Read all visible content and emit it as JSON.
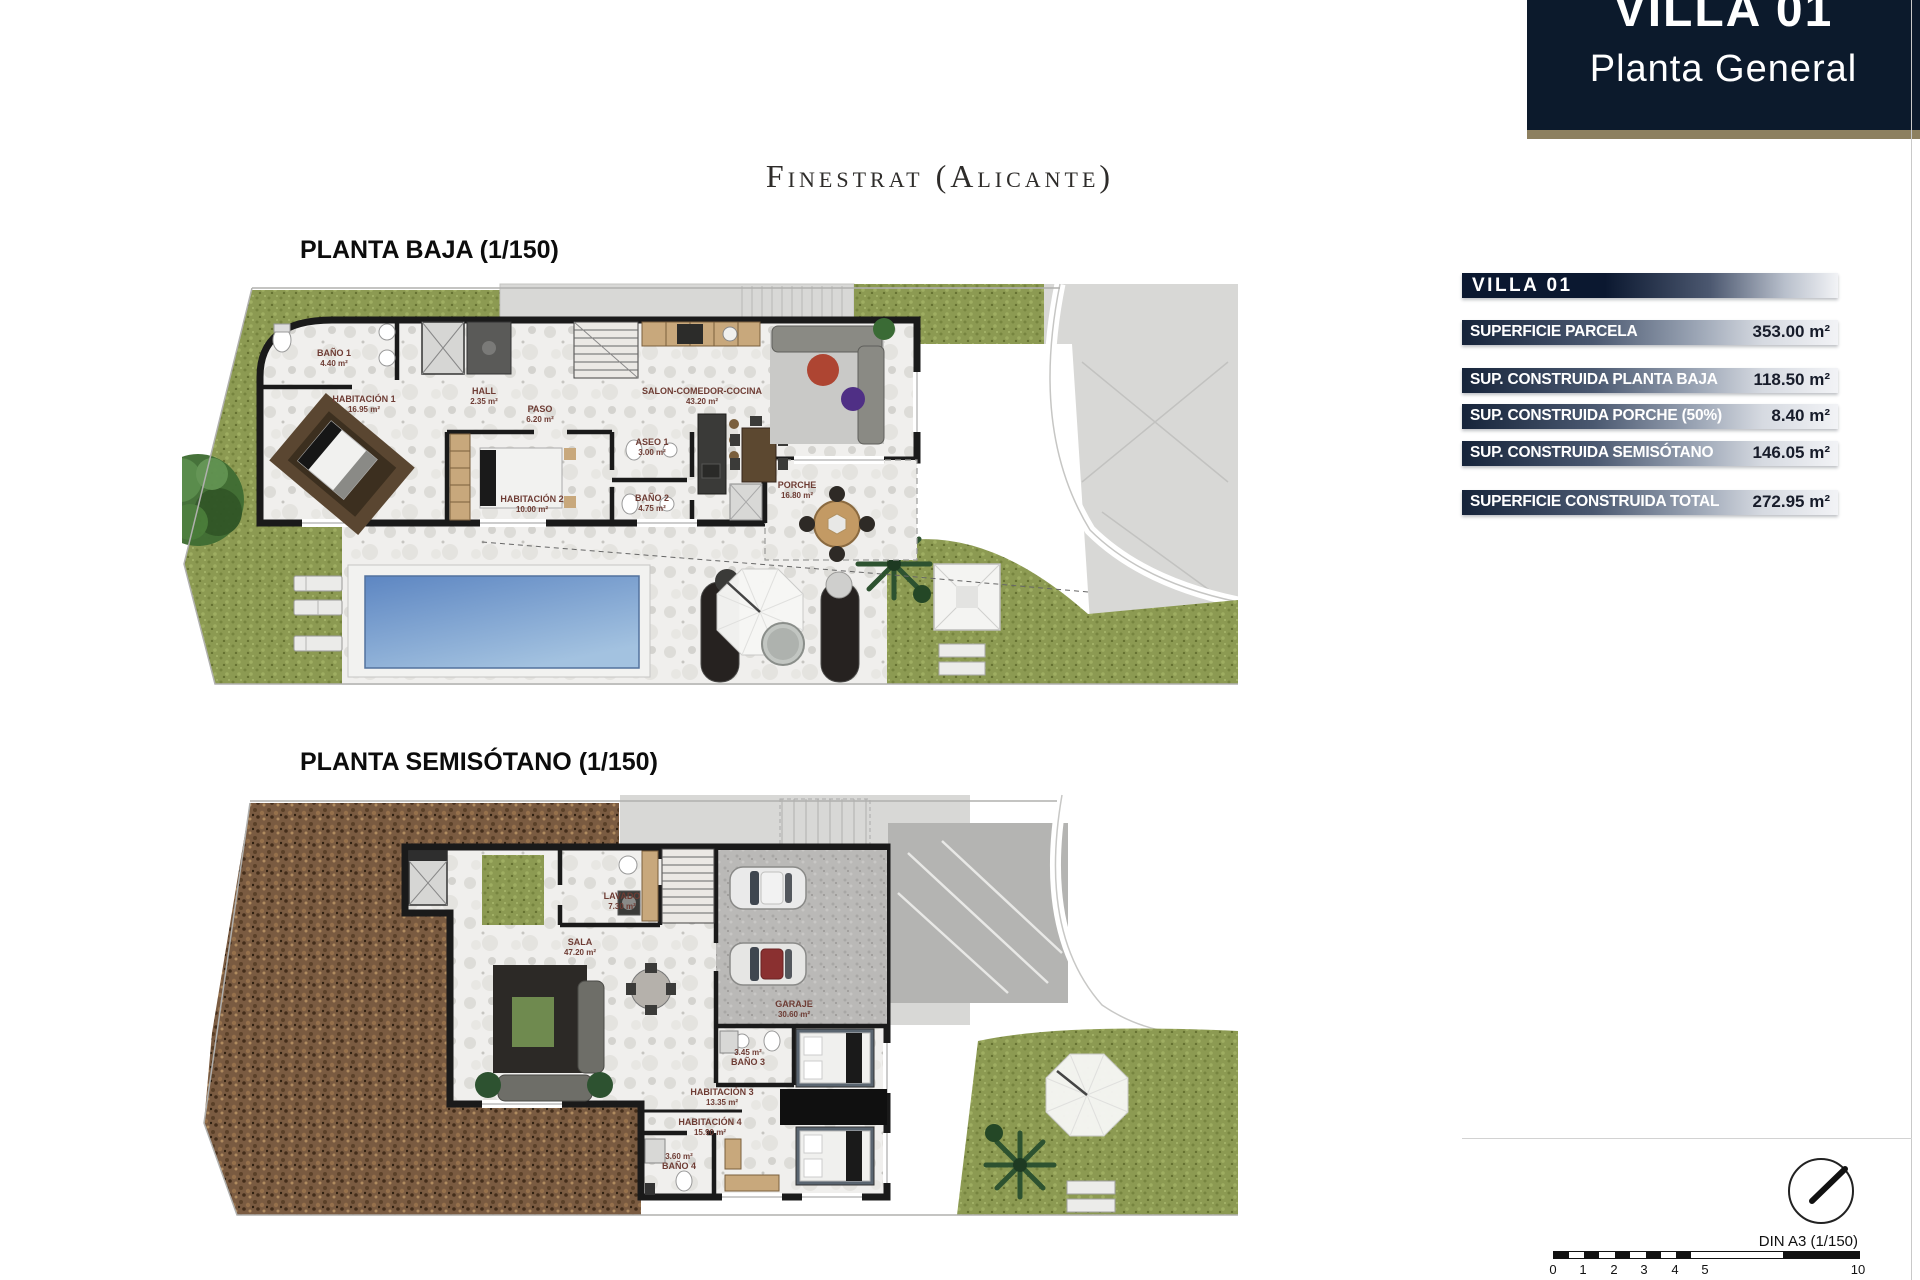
{
  "header": {
    "line1": "VILLA 01",
    "line2": "Planta General"
  },
  "subtitle": "Finestrat (Alicante)",
  "planta_baja": {
    "label": "PLANTA BAJA (1/150)",
    "rooms": [
      {
        "name": "BAÑO 1",
        "area": "4.40 m²"
      },
      {
        "name": "HABITACIÓN 1",
        "area": "16.95 m²"
      },
      {
        "name": "HALL",
        "area": "2.35 m²"
      },
      {
        "name": "PASO",
        "area": "6.20 m²"
      },
      {
        "name": "ASEO 1",
        "area": "3.00 m²"
      },
      {
        "name": "HABITACIÓN 2",
        "area": "10.00 m²"
      },
      {
        "name": "BAÑO 2",
        "area": "4.75 m²"
      },
      {
        "name": "SALON-COMEDOR-COCINA",
        "area": "43.20 m²"
      },
      {
        "name": "PORCHE",
        "area": "16.80 m²"
      }
    ]
  },
  "planta_semisotano": {
    "label": "PLANTA SEMISÓTANO (1/150)",
    "rooms": [
      {
        "name": "LAVADO",
        "area": "7.30 m²"
      },
      {
        "name": "SALA",
        "area": "47.20 m²"
      },
      {
        "name": "GARAJE",
        "area": "30.60 m²"
      },
      {
        "name": "BAÑO 3",
        "area": "3.45 m²"
      },
      {
        "name": "HABITACIÓN 3",
        "area": "13.35 m²"
      },
      {
        "name": "HABITACIÓN 4",
        "area": "15.90 m²"
      },
      {
        "name": "BAÑO 4",
        "area": "3.60 m²"
      }
    ]
  },
  "summary": {
    "title": "VILLA 01",
    "rows": [
      {
        "label": "SUPERFICIE PARCELA",
        "value": "353.00 m²"
      },
      {
        "label": "SUP. CONSTRUIDA PLANTA BAJA",
        "value": "118.50 m²"
      },
      {
        "label": "SUP. CONSTRUIDA PORCHE (50%)",
        "value": "8.40 m²"
      },
      {
        "label": "SUP. CONSTRUIDA SEMISÓTANO",
        "value": "146.05 m²"
      },
      {
        "label": "SUPERFICIE CONSTRUIDA TOTAL",
        "value": "272.95 m²"
      }
    ]
  },
  "footer": {
    "din_label": "DIN A3 (1/150)",
    "scale_ticks": [
      "0",
      "1",
      "2",
      "3",
      "4",
      "5",
      "10"
    ]
  },
  "colors": {
    "header_bg": "#0c1a2c",
    "accent_tan": "#8d8060",
    "grass": "#8c9a52",
    "dirt": "#7b5c42",
    "pool_blue": "#6089c4",
    "table_dark": "#16243a",
    "wall": "#1a1a1a",
    "room_label": "#6e3c34"
  }
}
